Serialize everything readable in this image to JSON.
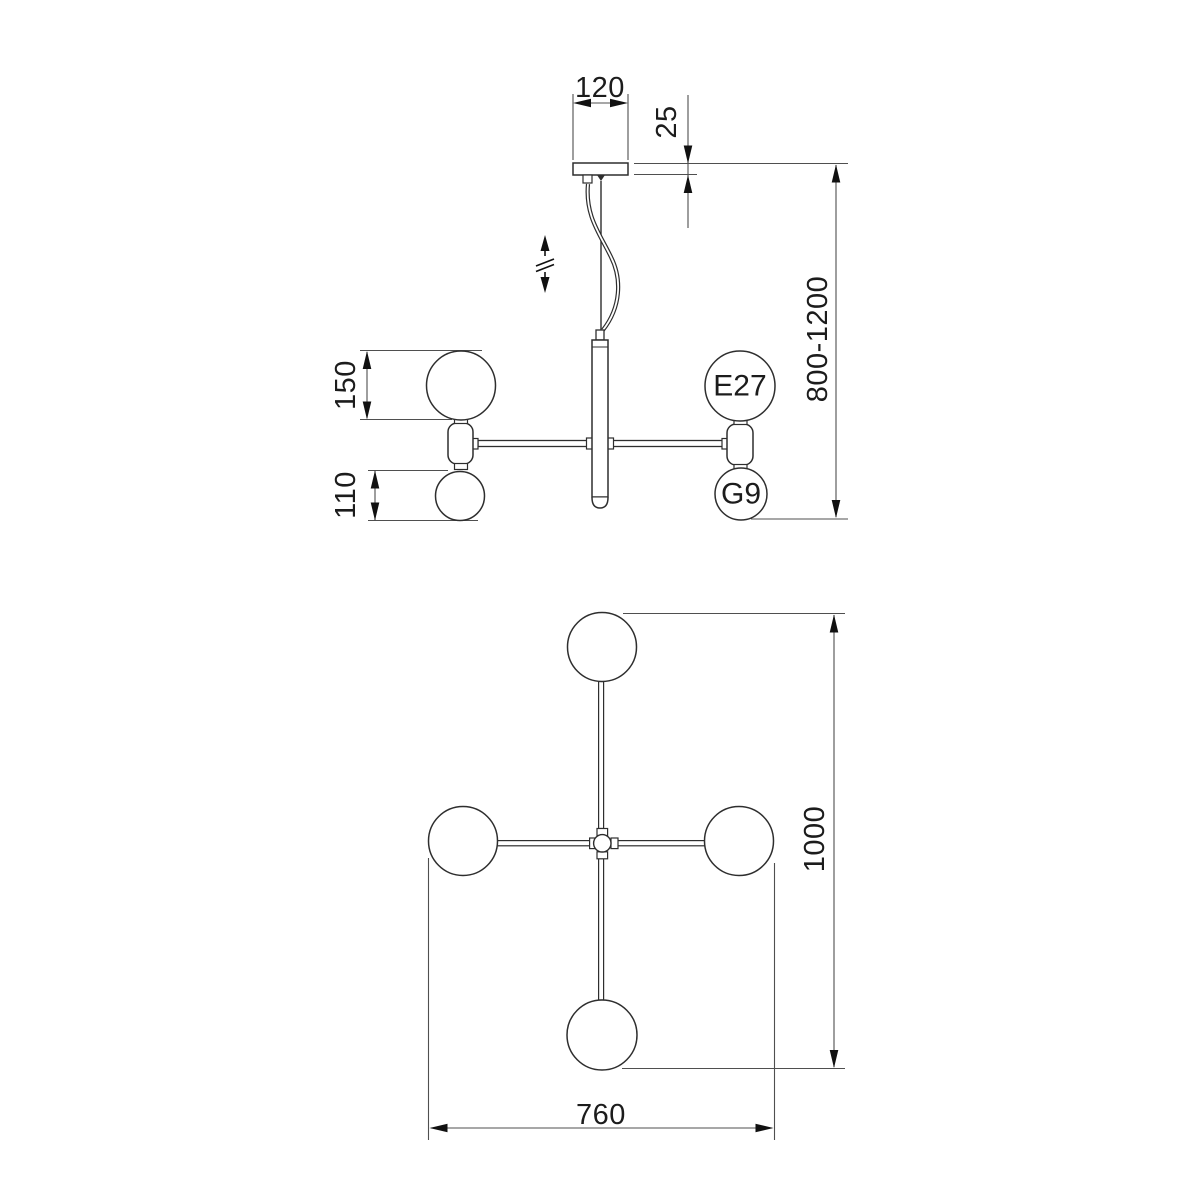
{
  "drawing": {
    "background": "#ffffff",
    "line_color": "#2e2e2e",
    "dimension_color": "#4f4f4f",
    "text_color": "#1c1c1c"
  },
  "side_view": {
    "canopy_width": "120",
    "canopy_height": "25",
    "suspension_height_range": "800-1200",
    "large_globe_diameter": "150",
    "small_globe_diameter": "110",
    "large_socket": "E27",
    "small_socket": "G9",
    "height_adjust_icon": "vertical-double-arrow-with-break"
  },
  "top_view": {
    "overall_length": "1000",
    "overall_width": "760"
  }
}
